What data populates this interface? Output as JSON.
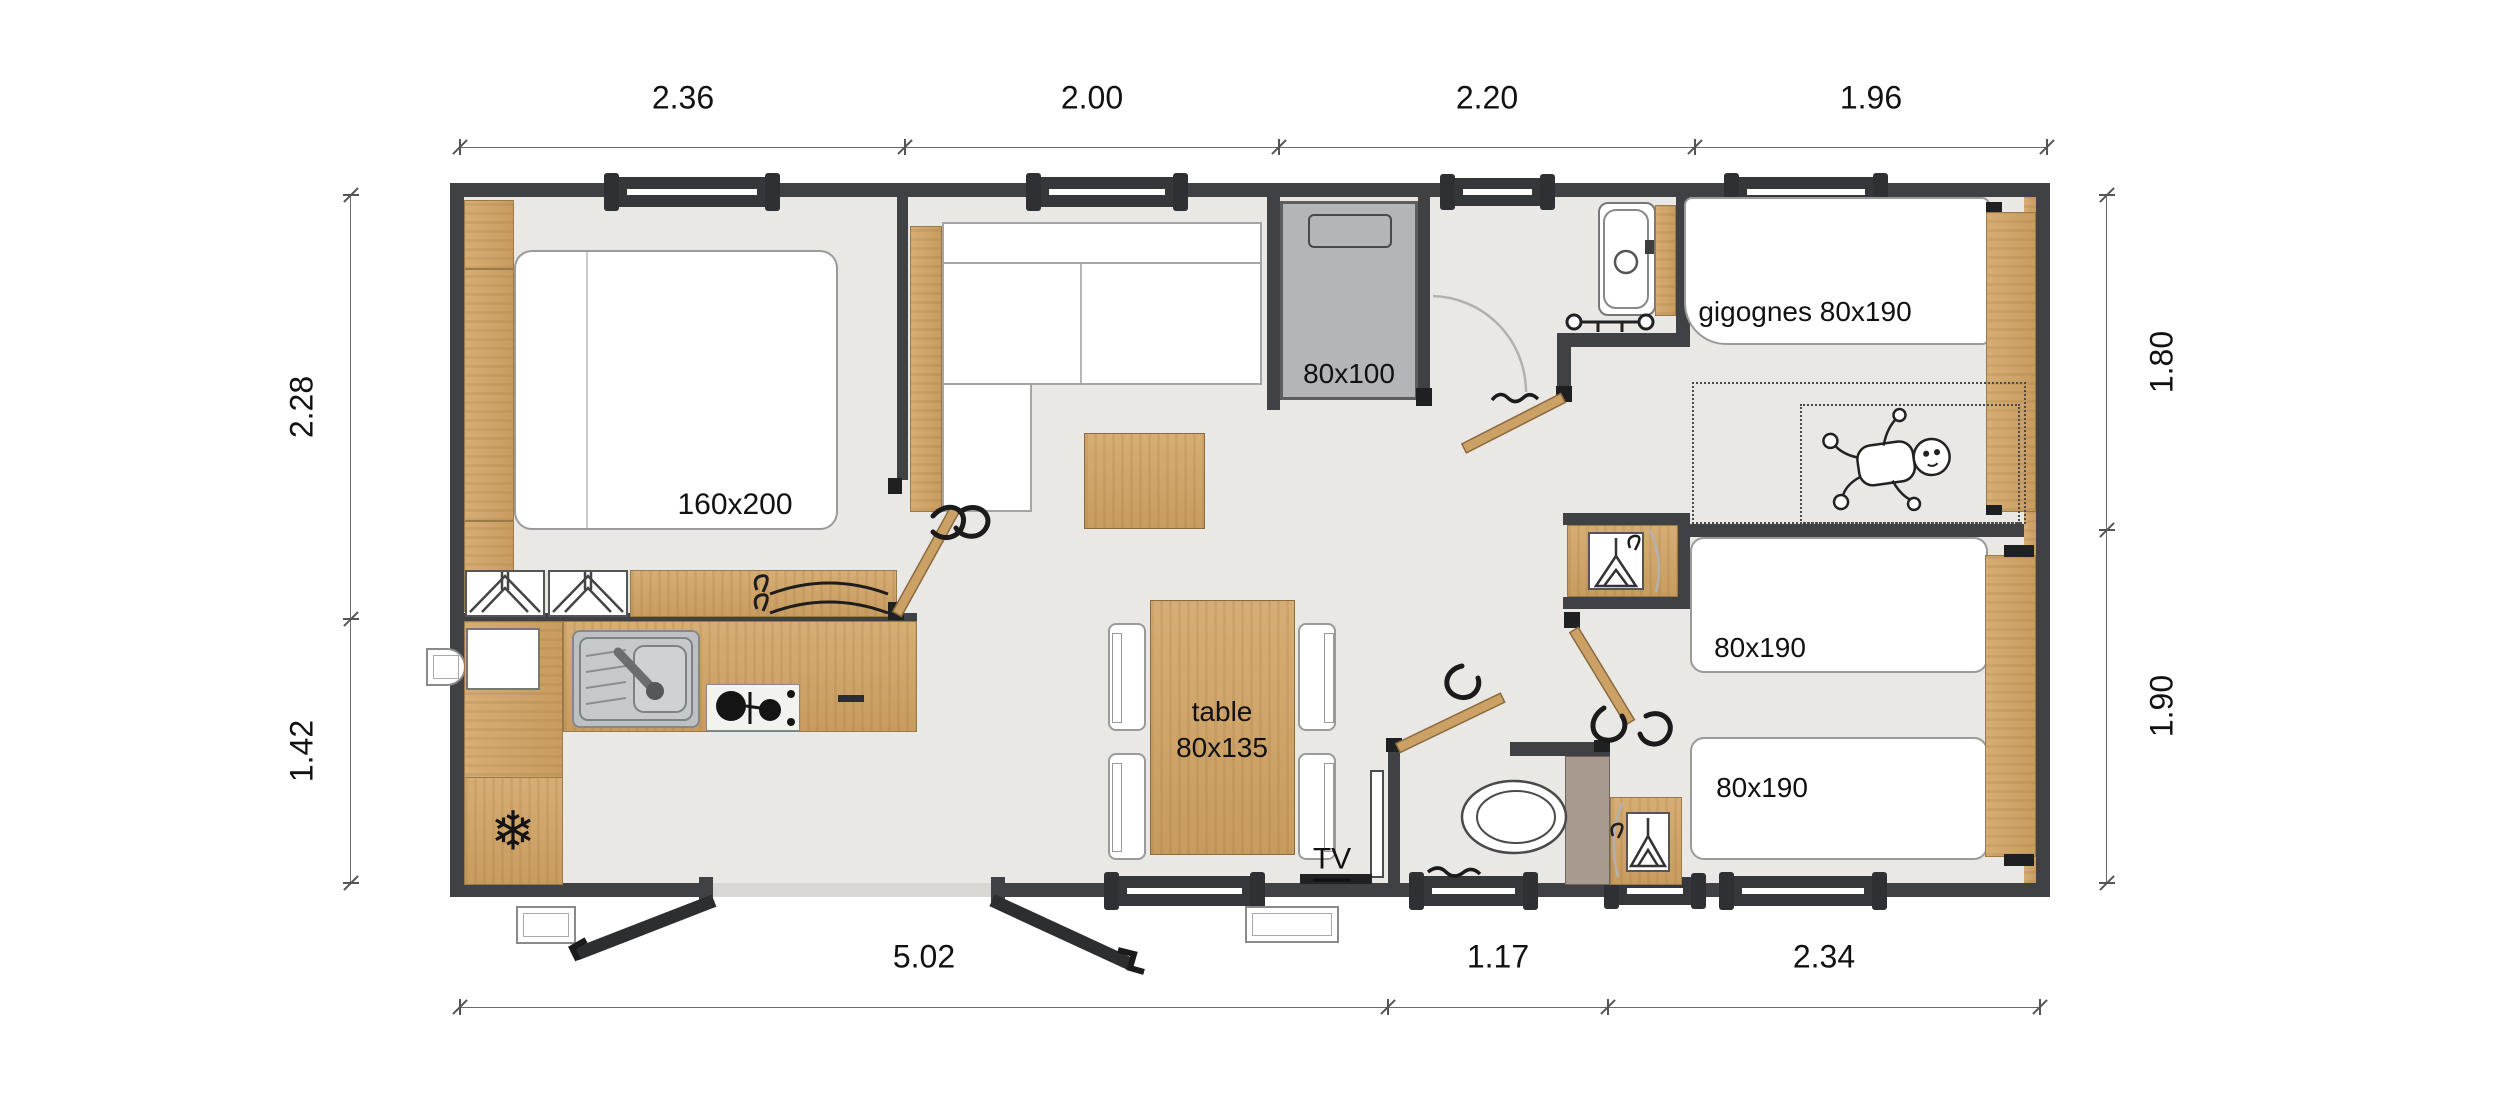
{
  "plan": {
    "dimensions_m": {
      "top": [
        "2.36",
        "2.00",
        "2.20",
        "1.96"
      ],
      "bottom": [
        "5.02",
        "1.17",
        "2.34"
      ],
      "left": [
        "2.28",
        "1.42"
      ],
      "right": [
        "1.80",
        "1.90"
      ]
    },
    "labels": {
      "master_bed": "160x200",
      "bunk_bed": "80x100",
      "trundle_beds": "gigognes 80x190",
      "twin_bed_1": "80x190",
      "twin_bed_2": "80x190",
      "dining_table_line1": "table",
      "dining_table_line2": "80x135",
      "tv": "TV"
    },
    "icons": {
      "fridge": "❄"
    },
    "colors": {
      "wall": "#3f4145",
      "wood": "#cda266",
      "floor": "#e9e8e5",
      "bunk_gray": "#b3b6b8",
      "taupe": "#a89a8f"
    }
  }
}
